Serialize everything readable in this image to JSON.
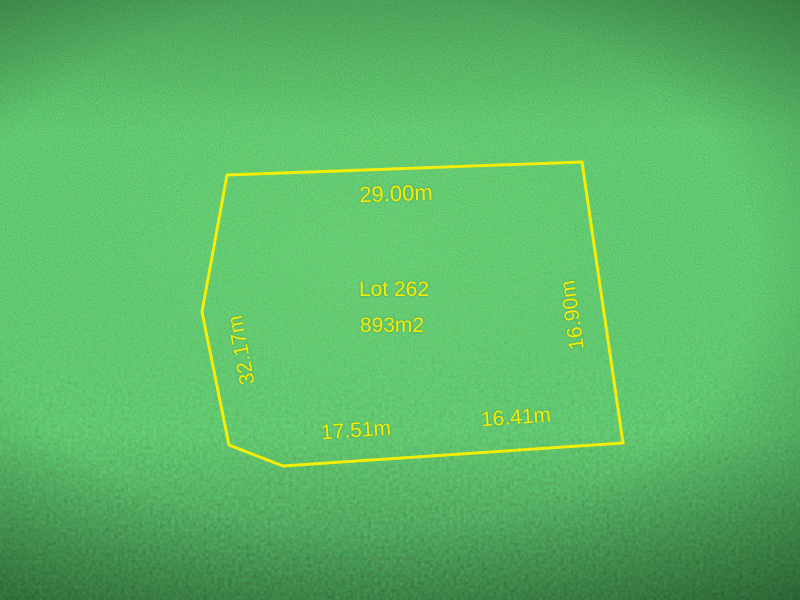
{
  "image": {
    "boundary_color": "#f2ee08",
    "label_color": "#f2ee08",
    "grass_base_color": "#1f942a",
    "grass_dark_edge_color": "#15531d"
  },
  "lot": {
    "name": "Lot 262",
    "area": "893m2",
    "outline_points": "227,175 582,162 623,443 283,466 229,445 202,312",
    "measurements": {
      "top": "29.00m",
      "left": "32.17m",
      "right": "16.90m",
      "bottom_left": "17.51m",
      "bottom_right": "16.41m"
    }
  }
}
